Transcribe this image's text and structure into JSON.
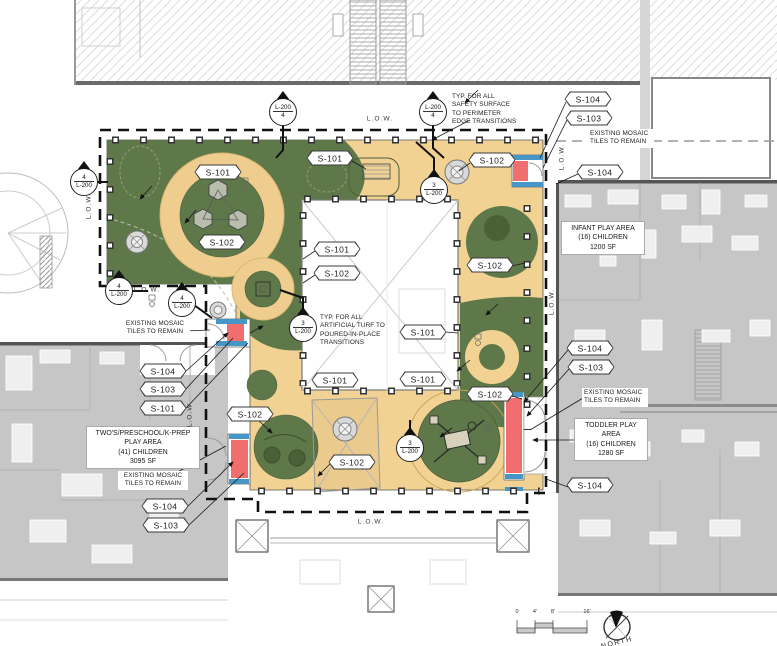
{
  "drawing": {
    "type": "courtyard-play-area-site-plan",
    "colors": {
      "turf_green": "#5E7849",
      "turf_dark": "#4A6138",
      "safety_surface_tan": "#F2D292",
      "ring_tan": "#EFCD8E",
      "building_gray": "#C6C6C6",
      "mosaic_red": "#F06E6E",
      "mosaic_blue": "#4696C8",
      "boundary_black": "#111111"
    }
  },
  "spec_tags": [
    {
      "label": "S-101",
      "x": 330,
      "y": 158
    },
    {
      "label": "S-102",
      "x": 492,
      "y": 160
    },
    {
      "label": "S-101",
      "x": 218,
      "y": 172
    },
    {
      "label": "S-102",
      "x": 222,
      "y": 242
    },
    {
      "label": "S-101",
      "x": 337,
      "y": 249
    },
    {
      "label": "S-102",
      "x": 337,
      "y": 273
    },
    {
      "label": "S-102",
      "x": 490,
      "y": 265
    },
    {
      "label": "S-101",
      "x": 423,
      "y": 332
    },
    {
      "label": "S-101",
      "x": 335,
      "y": 380
    },
    {
      "label": "S-101",
      "x": 423,
      "y": 379
    },
    {
      "label": "S-102",
      "x": 490,
      "y": 394
    },
    {
      "label": "S-102",
      "x": 250,
      "y": 414
    },
    {
      "label": "S-102",
      "x": 352,
      "y": 462
    },
    {
      "label": "S-104",
      "x": 588,
      "y": 99
    },
    {
      "label": "S-103",
      "x": 589,
      "y": 118
    },
    {
      "label": "S-104",
      "x": 600,
      "y": 172
    },
    {
      "label": "S-104",
      "x": 590,
      "y": 348
    },
    {
      "label": "S-103",
      "x": 591,
      "y": 367
    },
    {
      "label": "S-104",
      "x": 590,
      "y": 485
    },
    {
      "label": "S-104",
      "x": 163,
      "y": 371
    },
    {
      "label": "S-103",
      "x": 163,
      "y": 389
    },
    {
      "label": "S-101",
      "x": 163,
      "y": 408
    },
    {
      "label": "S-104",
      "x": 165,
      "y": 506
    },
    {
      "label": "S-103",
      "x": 166,
      "y": 525
    }
  ],
  "detail_markers": [
    {
      "line1": "L-200",
      "line2": "4",
      "x": 283,
      "y": 112
    },
    {
      "line1": "L-200",
      "line2": "4",
      "x": 433,
      "y": 112
    },
    {
      "line1": "4",
      "line2": "L-200",
      "x": 84,
      "y": 182
    },
    {
      "line1": "4",
      "line2": "L-200",
      "x": 119,
      "y": 291
    },
    {
      "line1": "4",
      "line2": "L-200",
      "x": 182,
      "y": 303
    },
    {
      "line1": "3",
      "line2": "L-200",
      "x": 434,
      "y": 190
    },
    {
      "line1": "3",
      "line2": "L-200",
      "x": 303,
      "y": 328
    },
    {
      "line1": "3",
      "line2": "L-200",
      "x": 410,
      "y": 448
    }
  ],
  "callouts": [
    {
      "lines": [
        "TYP. FOR ALL",
        "SAFETY SURFACE",
        "TO PERIMETER",
        "EDGE TRANSITIONS"
      ],
      "x": 452,
      "y": 93,
      "w": 66,
      "align": "left",
      "boxed": false
    },
    {
      "lines": [
        "TYP. FOR ALL",
        "ARTIFICIAL TURF TO",
        "POURED-IN-PLACE",
        "TRANSITIONS"
      ],
      "x": 320,
      "y": 314,
      "w": 66,
      "align": "left",
      "boxed": false
    },
    {
      "lines": [
        "EXISTING MOSAIC",
        "TILES TO REMAIN"
      ],
      "x": 588,
      "y": 129,
      "w": 62,
      "align": "left",
      "boxed": true
    },
    {
      "lines": [
        "EXISTING MOSAIC",
        "TILES TO REMAIN"
      ],
      "x": 120,
      "y": 319,
      "w": 66,
      "align": "center",
      "boxed": true
    },
    {
      "lines": [
        "EXISTING MOSAIC",
        "TILES TO REMAIN"
      ],
      "x": 118,
      "y": 471,
      "w": 66,
      "align": "center",
      "boxed": true
    },
    {
      "lines": [
        "EXISTING MOSAIC",
        "TILES TO REMAIN"
      ],
      "x": 582,
      "y": 388,
      "w": 62,
      "align": "left",
      "boxed": true
    }
  ],
  "area_labels": [
    {
      "lines": [
        "INFANT PLAY AREA",
        "(16) CHILDREN",
        "1200 SF"
      ],
      "x": 561,
      "y": 221,
      "w": 76
    },
    {
      "lines": [
        "TWO'S/PRESCHOOL/K-PREP",
        "PLAY AREA",
        "(41) CHILDREN",
        "3095 SF"
      ],
      "x": 86,
      "y": 426,
      "w": 106
    },
    {
      "lines": [
        "TODDLER PLAY",
        "AREA",
        "(16) CHILDREN",
        "1280 SF"
      ],
      "x": 574,
      "y": 418,
      "w": 66
    }
  ],
  "low_labels": [
    {
      "text": "L.O.W.",
      "x": 380,
      "y": 119,
      "orient": "h"
    },
    {
      "text": "L.O.W.",
      "x": 89,
      "y": 206,
      "orient": "v"
    },
    {
      "text": "L.O.W.",
      "x": 147,
      "y": 290,
      "orient": "h"
    },
    {
      "text": "L.O.W.",
      "x": 190,
      "y": 414,
      "orient": "v"
    },
    {
      "text": "L.O.W.",
      "x": 552,
      "y": 302,
      "orient": "v"
    },
    {
      "text": "L.O.W.",
      "x": 562,
      "y": 157,
      "orient": "v"
    },
    {
      "text": "L.O.W.",
      "x": 371,
      "y": 522,
      "orient": "h"
    }
  ],
  "compass": {
    "label": "NORTH"
  },
  "scale_bar": {
    "ticks": [
      "0",
      "4'",
      "8'",
      "16'"
    ]
  }
}
